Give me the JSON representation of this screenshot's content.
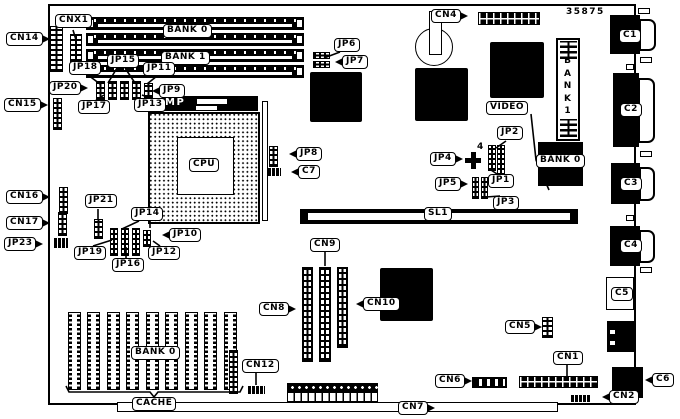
{
  "board": {
    "part_number": "35875",
    "labels": {
      "cnx1": "CNX1",
      "cn14": "CN14",
      "cn15": "CN15",
      "cn16": "CN16",
      "cn17": "CN17",
      "cn1": "CN1",
      "cn2": "CN2",
      "cn4": "CN4",
      "cn5": "CN5",
      "cn6": "CN6",
      "cn7": "CN7",
      "cn8": "CN8",
      "cn9": "CN9",
      "cn10": "CN10",
      "cn12": "CN12",
      "jp1": "JP1",
      "jp2": "JP2",
      "jp3": "JP3",
      "jp4": "JP4",
      "jp5": "JP5",
      "jp6": "JP6",
      "jp7": "JP7",
      "jp8": "JP8",
      "jp9": "JP9",
      "jp10": "JP10",
      "jp11": "JP11",
      "jp12": "JP12",
      "jp13": "JP13",
      "jp14": "JP14",
      "jp15": "JP15",
      "jp16": "JP16",
      "jp17": "JP17",
      "jp18": "JP18",
      "jp19": "JP19",
      "jp20": "JP20",
      "jp21": "JP21",
      "jp23": "JP23",
      "c1": "C1",
      "c2": "C2",
      "c3": "C3",
      "c4": "C4",
      "c5": "C5",
      "c6": "C6",
      "c7": "C7",
      "cpu": "CPU",
      "video": "VIDEO",
      "cache": "CACHE",
      "sl1": "SL1",
      "mp": "MP",
      "bank0": "BANK 0",
      "bank1": "BANK 1",
      "bank1_vertical": "BANK1",
      "marker4": "4"
    }
  }
}
